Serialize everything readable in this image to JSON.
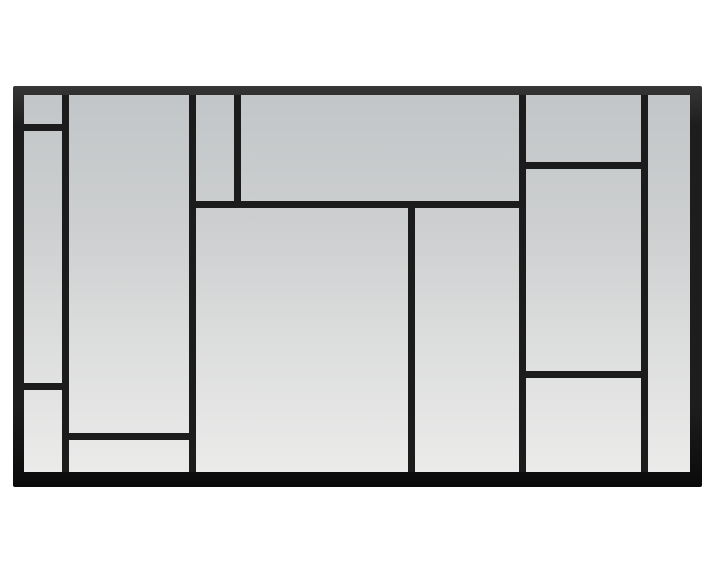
{
  "scene": {
    "background_color": "#ffffff",
    "subject": "window-pane-wall-mirror",
    "style": "mondrian-grid-black-metal-frame"
  },
  "mirror": {
    "frame_color": "#1d1d1d",
    "frame_top_highlight": "#363636",
    "frame_bottom_shade": "#0a0a0a",
    "mullion_color": "#1c1c1c",
    "glass_gradient": [
      {
        "color": "#c2c6c8",
        "pos": "0%"
      },
      {
        "color": "#cdcfd0",
        "pos": "35%"
      },
      {
        "color": "#dcdddd",
        "pos": "65%"
      },
      {
        "color": "#ebebea",
        "pos": "100%"
      }
    ],
    "outer_rect": {
      "x": 13,
      "y": 86,
      "w": 689,
      "h": 401
    },
    "glass_rect": {
      "x": 24,
      "y": 95,
      "w": 666,
      "h": 377
    },
    "mullions": {
      "vertical": [
        {
          "id": "left-column",
          "x": 62,
          "y": 95,
          "w": 7,
          "h": 377
        },
        {
          "id": "left-mid",
          "x": 189,
          "y": 95,
          "w": 7,
          "h": 377
        },
        {
          "id": "top-narrow",
          "x": 234,
          "y": 95,
          "w": 7,
          "h": 113
        },
        {
          "id": "center",
          "x": 408,
          "y": 201,
          "w": 7,
          "h": 271
        },
        {
          "id": "right-mid",
          "x": 519,
          "y": 95,
          "w": 7,
          "h": 377
        },
        {
          "id": "right-column",
          "x": 641,
          "y": 95,
          "w": 7,
          "h": 377
        }
      ],
      "horizontal": [
        {
          "id": "left-top",
          "x": 24,
          "y": 124,
          "w": 45,
          "h": 7
        },
        {
          "id": "right-top",
          "x": 519,
          "y": 162,
          "w": 129,
          "h": 7
        },
        {
          "id": "center-top",
          "x": 189,
          "y": 201,
          "w": 337,
          "h": 7
        },
        {
          "id": "right-lower",
          "x": 519,
          "y": 371,
          "w": 129,
          "h": 7
        },
        {
          "id": "left-lower",
          "x": 24,
          "y": 383,
          "w": 45,
          "h": 7
        },
        {
          "id": "left-mid-bottom",
          "x": 62,
          "y": 433,
          "w": 134,
          "h": 7
        }
      ]
    },
    "pane_count": 13
  }
}
